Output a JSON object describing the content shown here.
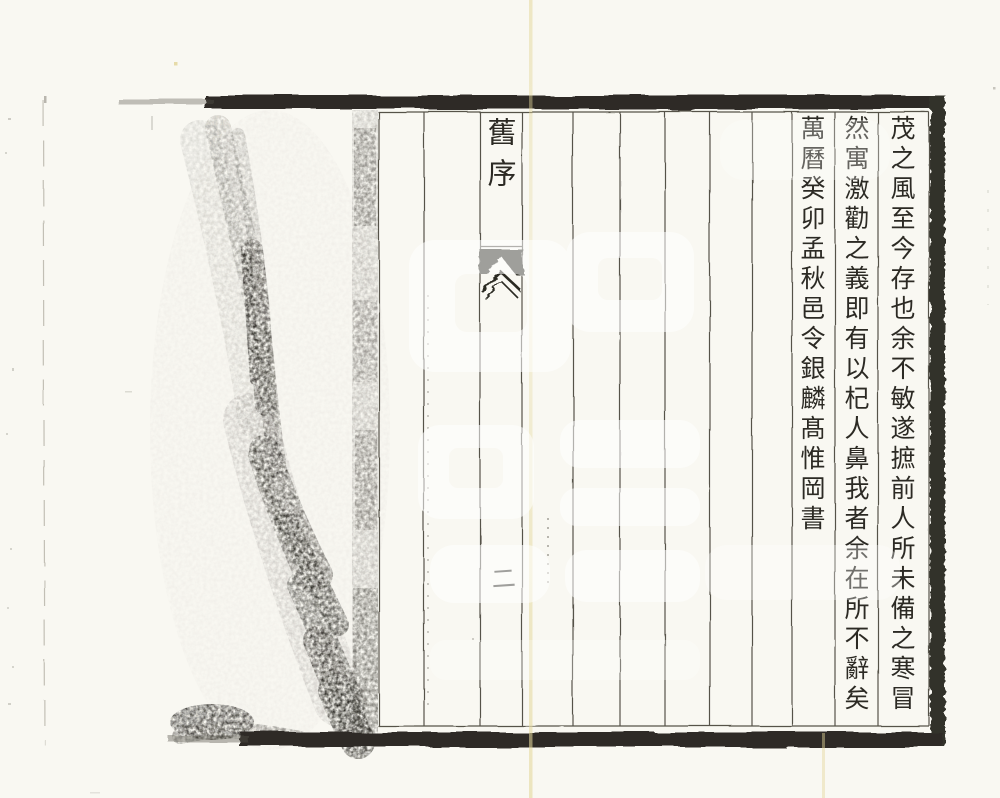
{
  "page": {
    "description": "scanned woodblock-printed Chinese book page",
    "paper_color": "#f9f8f2",
    "ink_color": "#2c2a24",
    "rule_color": "#57534a",
    "crease_color": "#e4d89c"
  },
  "banxin": {
    "section_title": "舊序",
    "page_number": "二"
  },
  "transcription": {
    "columns": [
      "茂之風至今存也余不敏遂摭前人所未備之寒冒",
      "然寓激勸之義即有以杞人鼻我者余在所不辭矣",
      "萬曆癸卯孟秋邑令銀麟髙惟岡書"
    ]
  }
}
